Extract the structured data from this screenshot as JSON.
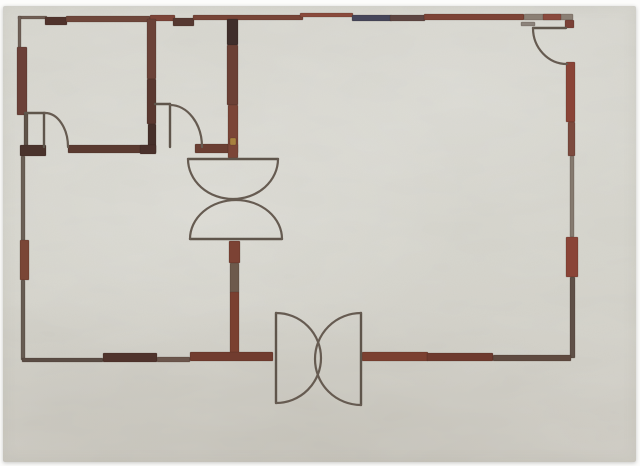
{
  "artwork": {
    "description": "Painting of an architectural floor plan",
    "canvas_color": "#d4d3cb",
    "border_color": "#fcfcfb",
    "wall_color": "#7a4034",
    "line_color": "#5f554b",
    "arc_color": "#665b51"
  },
  "plan": {
    "walls": [
      {
        "n": "top-wall-seg-1",
        "x": 18,
        "y": 16,
        "w": 29,
        "h": 3,
        "c": "#6f5d54"
      },
      {
        "n": "top-wall-step-1",
        "x": 45,
        "y": 17,
        "w": 22,
        "h": 8,
        "c": "#50332c"
      },
      {
        "n": "top-wall-seg-2",
        "x": 66,
        "y": 16,
        "w": 84,
        "h": 6,
        "c": "#6e463a"
      },
      {
        "n": "top-wall-seg-3",
        "x": 150,
        "y": 15,
        "w": 25,
        "h": 6,
        "c": "#7c4438"
      },
      {
        "n": "top-wall-step-2",
        "x": 173,
        "y": 18,
        "w": 21,
        "h": 8,
        "c": "#563831"
      },
      {
        "n": "top-wall-seg-4",
        "x": 193,
        "y": 15,
        "w": 110,
        "h": 5,
        "c": "#774437"
      },
      {
        "n": "top-wall-seg-5",
        "x": 300,
        "y": 13,
        "w": 53,
        "h": 4,
        "c": "#8a4a3c"
      },
      {
        "n": "top-wall-seg-navy",
        "x": 352,
        "y": 15,
        "w": 40,
        "h": 6,
        "c": "#45465a"
      },
      {
        "n": "top-wall-seg-6",
        "x": 390,
        "y": 15,
        "w": 35,
        "h": 6,
        "c": "#5d4542"
      },
      {
        "n": "top-wall-seg-7",
        "x": 424,
        "y": 14,
        "w": 100,
        "h": 6,
        "c": "#7d4336"
      },
      {
        "n": "top-wall-step-3",
        "x": 521,
        "y": 22,
        "w": 14,
        "h": 4,
        "c": "#8c837b"
      },
      {
        "n": "top-wall-seg-8",
        "x": 524,
        "y": 14,
        "w": 49,
        "h": 6,
        "c": "#8b7f74"
      },
      {
        "n": "top-wall-red-patch",
        "x": 543,
        "y": 14,
        "w": 18,
        "h": 6,
        "c": "#8a4a3e"
      },
      {
        "n": "left-wall-top-thin",
        "x": 18,
        "y": 16,
        "w": 3,
        "h": 34,
        "c": "#6f6058"
      },
      {
        "n": "left-wall-thick-upper",
        "x": 17,
        "y": 47,
        "w": 10,
        "h": 68,
        "c": "#6b4038"
      },
      {
        "n": "left-wall-door-jamb",
        "x": 24,
        "y": 113,
        "w": 4,
        "h": 34,
        "c": "#5f5349"
      },
      {
        "n": "left-wall-corner-block",
        "x": 20,
        "y": 145,
        "w": 26,
        "h": 11,
        "c": "#4a332c"
      },
      {
        "n": "left-wall-mid-thin",
        "x": 21,
        "y": 156,
        "w": 4,
        "h": 86,
        "c": "#6b6056"
      },
      {
        "n": "left-wall-thick-lower",
        "x": 20,
        "y": 240,
        "w": 9,
        "h": 40,
        "c": "#7a4636"
      },
      {
        "n": "left-wall-bottom-thin",
        "x": 21,
        "y": 280,
        "w": 4,
        "h": 80,
        "c": "#675c52"
      },
      {
        "n": "interior-wall-1-vertical-top",
        "x": 147,
        "y": 19,
        "w": 9,
        "h": 60,
        "c": "#6b4238"
      },
      {
        "n": "interior-wall-1-vertical-mid",
        "x": 147,
        "y": 79,
        "w": 9,
        "h": 45,
        "c": "#5a3830"
      },
      {
        "n": "interior-wall-1-vertical-bottom",
        "x": 148,
        "y": 124,
        "w": 8,
        "h": 29,
        "c": "#46302a"
      },
      {
        "n": "room-south-wall-left",
        "x": 68,
        "y": 145,
        "w": 88,
        "h": 8,
        "c": "#5a3a30"
      },
      {
        "n": "room-south-wall-dark-end",
        "x": 140,
        "y": 145,
        "w": 16,
        "h": 9,
        "c": "#4a312b"
      },
      {
        "n": "room-south-wall-right",
        "x": 195,
        "y": 144,
        "w": 43,
        "h": 9,
        "c": "#6b3f33"
      },
      {
        "n": "interior-wall-2-vertical-top",
        "x": 227,
        "y": 19,
        "w": 11,
        "h": 26,
        "c": "#3f2e2b"
      },
      {
        "n": "interior-wall-2-vertical-mid",
        "x": 227,
        "y": 45,
        "w": 11,
        "h": 60,
        "c": "#6b4035"
      },
      {
        "n": "interior-wall-2-vertical-bottom",
        "x": 228,
        "y": 105,
        "w": 10,
        "h": 53,
        "c": "#7b4537"
      },
      {
        "n": "interior-wall-2-gold-speck",
        "x": 230,
        "y": 138,
        "w": 6,
        "h": 7,
        "c": "#a8813f"
      },
      {
        "n": "center-lower-wall-top",
        "x": 229,
        "y": 241,
        "w": 11,
        "h": 22,
        "c": "#7c4234"
      },
      {
        "n": "center-lower-wall-mid",
        "x": 230,
        "y": 263,
        "w": 9,
        "h": 30,
        "c": "#6d5a4c"
      },
      {
        "n": "center-lower-wall-bottom",
        "x": 230,
        "y": 292,
        "w": 9,
        "h": 66,
        "c": "#7a4030"
      },
      {
        "n": "right-wall-corner-stub",
        "x": 565,
        "y": 20,
        "w": 9,
        "h": 8,
        "c": "#7a4036"
      },
      {
        "n": "right-wall-red-upper",
        "x": 566,
        "y": 62,
        "w": 9,
        "h": 60,
        "c": "#8a4437"
      },
      {
        "n": "right-wall-red-fade",
        "x": 568,
        "y": 122,
        "w": 7,
        "h": 34,
        "c": "#7c4a3e"
      },
      {
        "n": "right-wall-thin-mid",
        "x": 570,
        "y": 156,
        "w": 4,
        "h": 81,
        "c": "#857a6f"
      },
      {
        "n": "right-wall-thick-notch",
        "x": 566,
        "y": 237,
        "w": 12,
        "h": 40,
        "c": "#8a4437"
      },
      {
        "n": "right-wall-thin-lower",
        "x": 570,
        "y": 277,
        "w": 5,
        "h": 81,
        "c": "#5f5047"
      },
      {
        "n": "bottom-wall-seg-1",
        "x": 22,
        "y": 358,
        "w": 81,
        "h": 4,
        "c": "#5a4c44"
      },
      {
        "n": "bottom-wall-thick-dark",
        "x": 103,
        "y": 353,
        "w": 54,
        "h": 9,
        "c": "#4f332c"
      },
      {
        "n": "bottom-wall-seg-2",
        "x": 157,
        "y": 357,
        "w": 33,
        "h": 5,
        "c": "#6b564c"
      },
      {
        "n": "bottom-wall-thick-red-left",
        "x": 190,
        "y": 352,
        "w": 83,
        "h": 9,
        "c": "#713c2f"
      },
      {
        "n": "bottom-wall-thick-red-right",
        "x": 362,
        "y": 352,
        "w": 66,
        "h": 9,
        "c": "#7b4031"
      },
      {
        "n": "bottom-wall-seg-3",
        "x": 427,
        "y": 353,
        "w": 66,
        "h": 8,
        "c": "#6e3a2e"
      },
      {
        "n": "bottom-wall-seg-4",
        "x": 493,
        "y": 355,
        "w": 78,
        "h": 6,
        "c": "#5f4a40"
      }
    ],
    "lines": [
      {
        "n": "door1-lintel-line",
        "x1": 25,
        "y1": 113,
        "x2": 45,
        "y2": 113
      },
      {
        "n": "door1-leaf",
        "x1": 44,
        "y1": 113,
        "x2": 44,
        "y2": 147
      },
      {
        "n": "door2-stub-line",
        "x1": 155,
        "y1": 104,
        "x2": 170,
        "y2": 104
      },
      {
        "n": "door2-leaf",
        "x1": 170,
        "y1": 104,
        "x2": 170,
        "y2": 147
      },
      {
        "n": "center-door-top-chord",
        "x1": 188,
        "y1": 159,
        "x2": 278,
        "y2": 159
      },
      {
        "n": "center-door-bottom-chord",
        "x1": 190,
        "y1": 239,
        "x2": 282,
        "y2": 239
      },
      {
        "n": "topright-door-leaf",
        "x1": 533,
        "y1": 28,
        "x2": 566,
        "y2": 28
      },
      {
        "n": "bottom-door-left-leaf",
        "x1": 276,
        "y1": 313,
        "x2": 276,
        "y2": 403
      },
      {
        "n": "bottom-door-right-leaf",
        "x1": 361,
        "y1": 313,
        "x2": 361,
        "y2": 405
      }
    ],
    "arcs": [
      {
        "n": "door1-swing-arc",
        "d": "M45,113 A23,34 0 0 1 68,147"
      },
      {
        "n": "door2-swing-arc",
        "d": "M170,105 A32,42 0 0 1 202,147"
      },
      {
        "n": "center-door-top-swing-arc",
        "d": "M188,159 A45,40 0 0 0 278,159"
      },
      {
        "n": "center-door-bottom-swing-arc",
        "d": "M190,239 A46,39 0 0 1 282,239"
      },
      {
        "n": "topright-door-swing-arc",
        "d": "M533,28 A34,36 0 0 0 567,64"
      },
      {
        "n": "bottom-door-left-swing-arc",
        "d": "M276,313 A45,45 0 0 1 276,403"
      },
      {
        "n": "bottom-door-right-swing-arc",
        "d": "M361,313 A46,46 0 0 0 361,405"
      }
    ]
  }
}
